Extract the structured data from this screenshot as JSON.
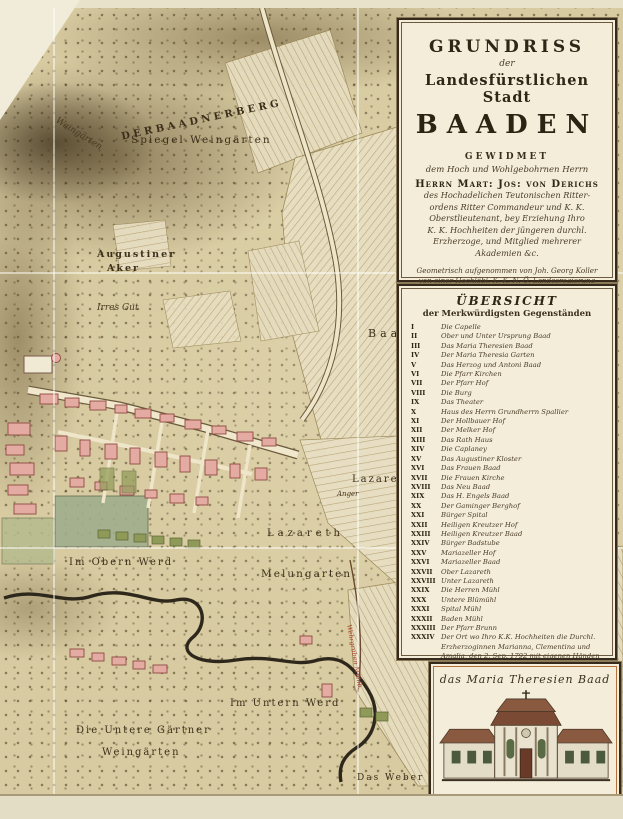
{
  "cartouche": {
    "title_line1": "GRUNDRISS",
    "title_line2": "der",
    "title_line3": "Landesfürstlichen Stadt",
    "title_line4": "BAADEN",
    "dedication_heading": "GEWIDMET",
    "dedication_sub": "dem Hoch und Wohlgebohrnen Herrn",
    "dedication_name": "Herrn Mart: Jos: von Derichs",
    "dedication_lines": [
      "des Hochadelichen Teutonischen Ritter-",
      "ordens Ritter Commandeur und K. K.",
      "Oberstlieutenant, bey Erziehung Ihro",
      "K. K. Hochheiten der jüngeren durchl.",
      "Erzherzoge, und Mitglied mehrerer",
      "Akademien &c."
    ],
    "imprint_lines": [
      "Geometrisch aufgenommen von Joh. Georg Koller",
      "von einer Hochlöbl. K. K. N. Ö. Landesregierung",
      "in deren Aufnahme dahier vereinbarter Ingenieur"
    ],
    "publisher_line": "Gestochen von Hieronymus Benedicti in Wien 1798"
  },
  "legend": {
    "heading1": "ÜBERSICHT",
    "heading2": "der Merkwürdigsten Gegenständen",
    "items": [
      {
        "numeral": "I",
        "label": "Die Capelle"
      },
      {
        "numeral": "II",
        "label": "Ober und Unter Ursprung Baad"
      },
      {
        "numeral": "III",
        "label": "Das Maria Theresien Baad"
      },
      {
        "numeral": "IV",
        "label": "Der Maria Theresia Garten"
      },
      {
        "numeral": "V",
        "label": "Das Herzog und Antoni Baad"
      },
      {
        "numeral": "VI",
        "label": "Die Pfarr Kirchen"
      },
      {
        "numeral": "VII",
        "label": "Der Pfarr Hof"
      },
      {
        "numeral": "VIII",
        "label": "Die Burg"
      },
      {
        "numeral": "IX",
        "label": "Das Theater"
      },
      {
        "numeral": "X",
        "label": "Haus des Herrn Grundherrn Spallier"
      },
      {
        "numeral": "XI",
        "label": "Der Hollbauer Hof"
      },
      {
        "numeral": "XII",
        "label": "Der Melker Hof"
      },
      {
        "numeral": "XIII",
        "label": "Das Rath Haus"
      },
      {
        "numeral": "XIV",
        "label": "Die Caplaney"
      },
      {
        "numeral": "XV",
        "label": "Das Augustiner Kloster"
      },
      {
        "numeral": "XVI",
        "label": "Das Frauen Baad"
      },
      {
        "numeral": "XVII",
        "label": "Die Frauen Kirche"
      },
      {
        "numeral": "XVIII",
        "label": "Das Neu Baad"
      },
      {
        "numeral": "XIX",
        "label": "Das H. Engels Baad"
      },
      {
        "numeral": "XX",
        "label": "Der Gaminger Berghof"
      },
      {
        "numeral": "XXI",
        "label": "Bürger Spital"
      },
      {
        "numeral": "XXII",
        "label": "Heiligen Kreutzer Hof"
      },
      {
        "numeral": "XXIII",
        "label": "Heiligen Kreutzer Baad"
      },
      {
        "numeral": "XXIV",
        "label": "Bürger Badstube"
      },
      {
        "numeral": "XXV",
        "label": "Mariazeller Hof"
      },
      {
        "numeral": "XXVI",
        "label": "Mariazeller Baad"
      },
      {
        "numeral": "XXVII",
        "label": "Ober Lazareth"
      },
      {
        "numeral": "XXVIII",
        "label": "Unter Lazareth"
      },
      {
        "numeral": "XXIX",
        "label": "Die Herren Mühl"
      },
      {
        "numeral": "XXX",
        "label": "Untere Blümühl"
      },
      {
        "numeral": "XXXI",
        "label": "Spital Mühl"
      },
      {
        "numeral": "XXXII",
        "label": "Baden Mühl"
      },
      {
        "numeral": "XXXIII",
        "label": "Der Pfarr Brunn"
      },
      {
        "numeral": "XXXIV",
        "label": "Der Ort wo Ihro K.K. Hochheiten die Durchl. Erzherzoginnen Marianna, Clementina und Amalia, den 2. Sep. 1792 mit eigenen Händen Kirschen Bäumchen gesetzt haben."
      }
    ]
  },
  "illustration": {
    "caption": "das Maria Theresien Baad"
  },
  "map": {
    "labels": {
      "der_baadner_berg": "D E R   B A A D N E R   B E R G",
      "spiegel_weingarten": "Spiegel Weingärten",
      "weingarten_slope": "Weingärten",
      "augustiner_aker_1": "Augustiner",
      "augustiner_aker_2": "Aker",
      "irres_gut": "Irres Gut",
      "baadner_feld": "Baadner  Feld",
      "lazareth_aker": "Lazareth  Aker",
      "anger": "Anger",
      "lazareth": "Lazareth",
      "melungarten": "Melungarten",
      "im_obern_werd": "Im  Obern  Werd",
      "herrschaft_leesdorf": "HERRSCHAFT LEESDORF",
      "wehrgraben": "Wehrgraben Mühlb.",
      "im_untern_werd": "Im  Untern  Werd",
      "untere_weingarten_1": "Die  Untere  Gärtner",
      "untere_weingarten_2": "Weingärten",
      "das_weber_feld": "Das Weber Feld"
    }
  },
  "colors": {
    "paper": "#e9e2cb",
    "terrain": "#d8cba1",
    "boundary_red": "#a8432b",
    "building_pink": "#e4aba3",
    "roof_brown": "#8a5a40"
  }
}
